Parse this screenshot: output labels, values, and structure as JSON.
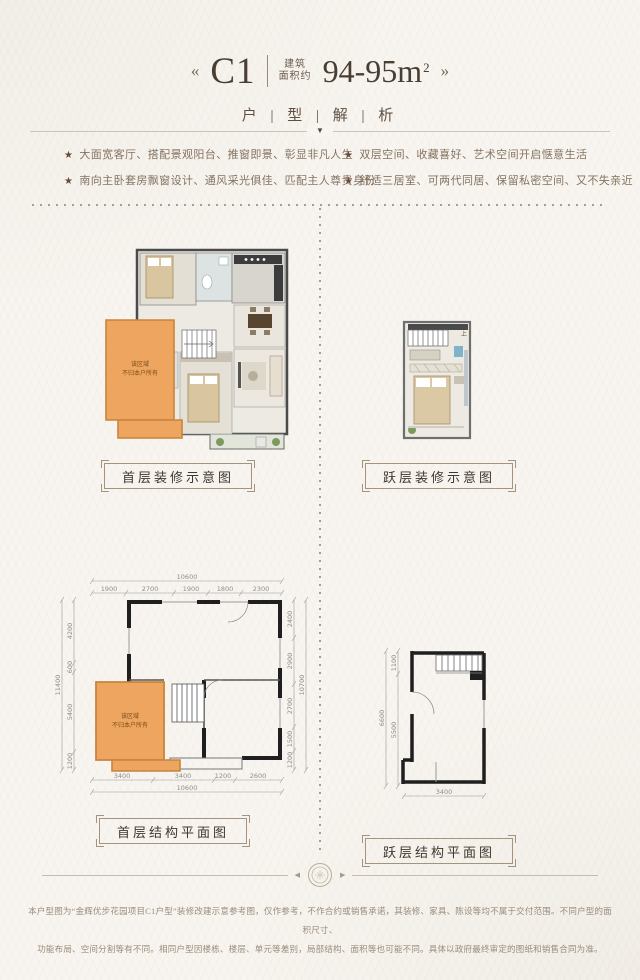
{
  "header": {
    "arrow_left": "«",
    "arrow_right": "»",
    "unit_code": "C1",
    "area_label_top": "建筑",
    "area_label_bottom": "面积约",
    "area_value": "94-95m",
    "area_exponent": "2",
    "subtitle": "户 | 型 | 解 | 析"
  },
  "features": {
    "star": "★",
    "left": [
      "大面宽客厅、搭配景观阳台、推窗即景、彰显非凡人生",
      "南向主卧套房飘窗设计、通风采光俱佳、匹配主人尊贵身份"
    ],
    "right": [
      "双层空间、收藏喜好、艺术空间开启惬意生活",
      "舒适三居室、可两代同居、保留私密空间、又不失亲近"
    ]
  },
  "plans": {
    "decor_first": {
      "caption": "首层装修示意图",
      "overlay": {
        "line1": "该区域",
        "line2": "不归本户所有"
      }
    },
    "decor_loft": {
      "caption": "跃层装修示意图",
      "stair_up": "上"
    },
    "struct_first": {
      "caption": "首层结构平面图",
      "overlay": {
        "line1": "该区域",
        "line2": "不归本户所有"
      },
      "dims": {
        "top": [
          "1900",
          "2700",
          "1900",
          "1800",
          "2300"
        ],
        "top_total": "10600",
        "left": [
          "4200",
          "600",
          "5400",
          "1200"
        ],
        "left_total": "11400",
        "right": [
          "2400",
          "2900",
          "2700",
          "1500",
          "1200"
        ],
        "right_total": "10700",
        "bottom": [
          "3400",
          "3400",
          "1200",
          "2600"
        ],
        "bottom_total": "10600"
      }
    },
    "struct_loft": {
      "caption": "跃层结构平面图",
      "dims": {
        "left": [
          "1100",
          "5500"
        ],
        "left_total": "6600",
        "bottom": "3400"
      }
    }
  },
  "ornament": {
    "divider_down_icon": "▼",
    "arrow_left_icon": "◀",
    "arrow_right_icon": "▶",
    "seal_icon": "seal-emblem"
  },
  "footer": {
    "line1": "本户型图为“金辉优步花园项目C1户型”装修改建示意参考图，仅作参考，不作合约或销售承诺，其装修、家具、陈设等均不属于交付范围。不同户型的面积尺寸、",
    "line2": "功能布局、空间分割等有不同。相同户型因楼栋、楼层、单元等差别，局部结构、面积等也可能不同。具体以政府最终审定的图纸和销售合同为准。"
  },
  "colors": {
    "accent_orange": "#EDA55F",
    "title": "#483E33",
    "body_text": "#847361",
    "dim_text": "#8D8D8D",
    "wall": "#1F1F1F"
  }
}
